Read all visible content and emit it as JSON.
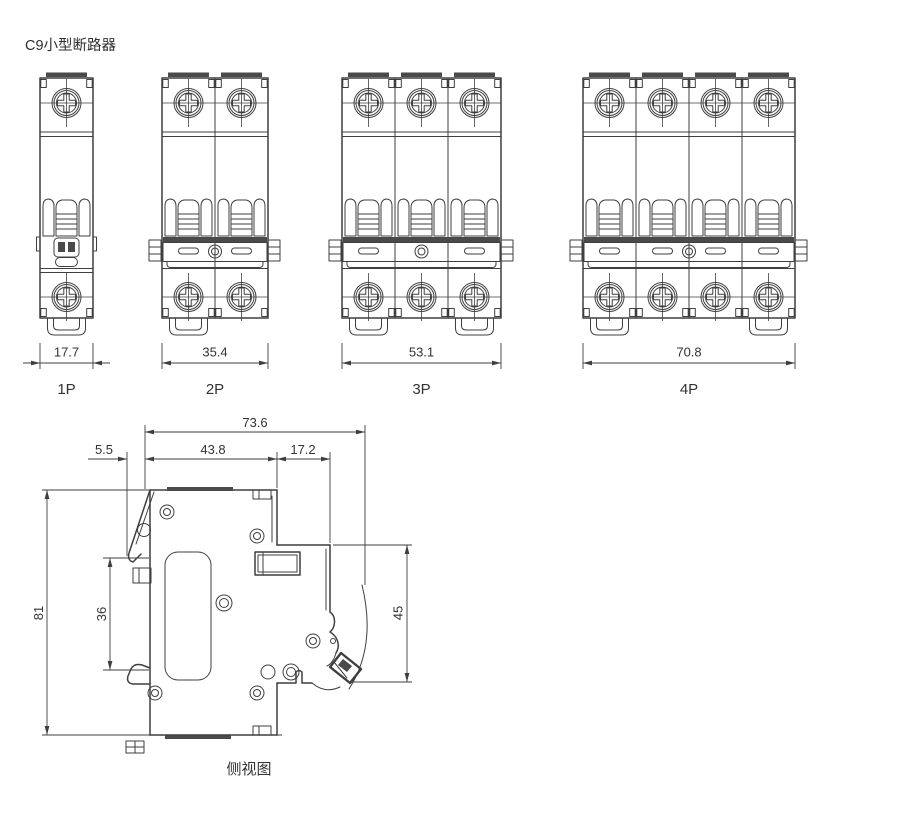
{
  "page": {
    "title": "C9小型断路器",
    "background": "#ffffff",
    "line_color": "#3f3f3f",
    "text_color": "#333333"
  },
  "front_views": [
    {
      "label": "1P",
      "poles": 1,
      "width_dim": "17.7"
    },
    {
      "label": "2P",
      "poles": 2,
      "width_dim": "35.4"
    },
    {
      "label": "3P",
      "poles": 3,
      "width_dim": "53.1"
    },
    {
      "label": "4P",
      "poles": 4,
      "width_dim": "70.8"
    }
  ],
  "side_view": {
    "label": "侧视图",
    "dims": {
      "overall_depth": "73.6",
      "rail_offset": "5.5",
      "body_depth": "43.8",
      "front_depth": "17.2",
      "height": "81",
      "rail_notch_height": "36",
      "front_height": "45"
    }
  }
}
